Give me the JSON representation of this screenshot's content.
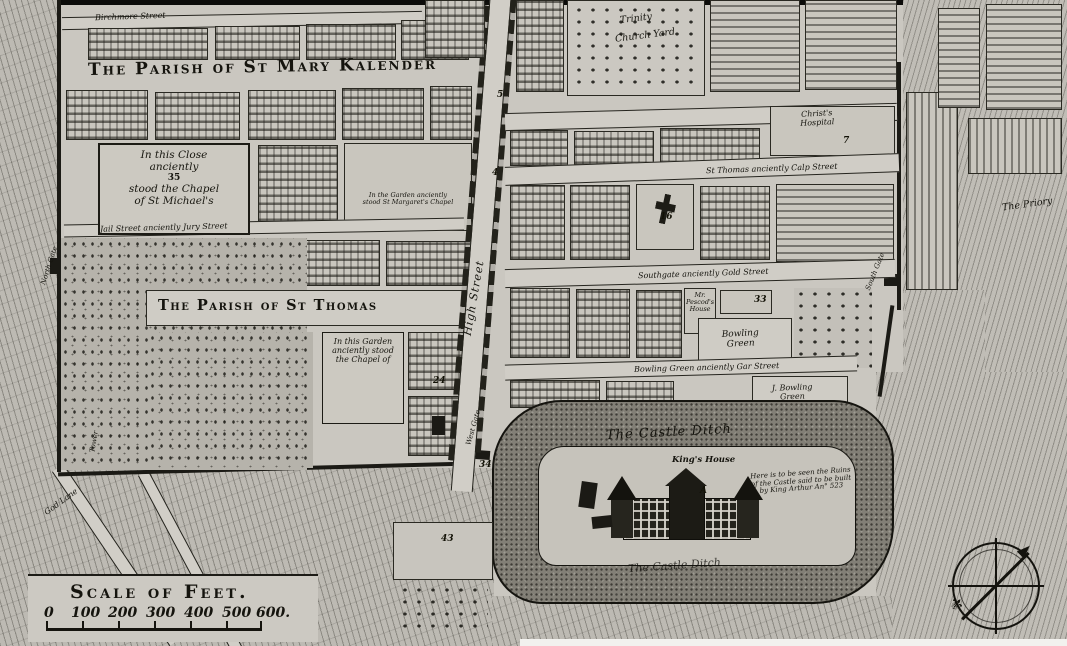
{
  "parishes": {
    "mary": "The Parish of St Mary Kalender",
    "thomas": "The Parish of St Thomas"
  },
  "streets": {
    "high": "High Street",
    "birchmore": "Birchmore Street",
    "jury": "Jail Street anciently Jury Street",
    "calp": "St Thomas anciently Calp Street",
    "gold": "Southgate anciently Gold Street",
    "gar": "Bowling Green anciently Gar Street",
    "god_lane": "God Lane"
  },
  "gates": {
    "north": "North Gate",
    "west": "West Gate",
    "south": "South Gate"
  },
  "notes": {
    "close": [
      "In this Close",
      "anciently",
      "35",
      "stood the Chapel",
      "of St Michael's"
    ],
    "garden": [
      "In this Garden",
      "anciently stood",
      "the Chapel of"
    ],
    "margaret": [
      "In the Garden anciently",
      "stood St Margaret's Chapel"
    ],
    "arthur": [
      "Here is to be seen the Ruins",
      "of the Castle said to be built",
      "by King Arthur An° 523"
    ]
  },
  "places": {
    "trinity": [
      "Trinity",
      "Church Yard"
    ],
    "christs_hospital": [
      "Christ's",
      "Hospital"
    ],
    "priory": "The Priory",
    "castle_ditch_upper": "The Castle Ditch",
    "castle_ditch_lower": "The Castle Ditch",
    "kings_house": "King's House",
    "pescod": [
      "Mr.",
      "Pescod's",
      "House"
    ],
    "bowling_green": [
      "Bowling",
      "Green"
    ],
    "j_bowling_green": [
      "J. Bowling",
      "Green"
    ],
    "tower": "Tower"
  },
  "markers": {
    "high_street_5": "5",
    "high_street_4": "4",
    "church_16": "16",
    "plot_33": "33",
    "hospital_7": "7",
    "garden_24": "24",
    "westgate_34": "34",
    "plot_43": "43",
    "castle_a": "A"
  },
  "scale": {
    "title": "Scale of Feet.",
    "ticks": [
      "0",
      "100",
      "200",
      "300",
      "400",
      "500",
      "600."
    ]
  },
  "compass": {
    "fleur": "⚜"
  },
  "colors": {
    "paper": "#c9c6bf",
    "ink": "#17160f",
    "ditch": "#827f76",
    "woods": "#b6b3ab"
  }
}
